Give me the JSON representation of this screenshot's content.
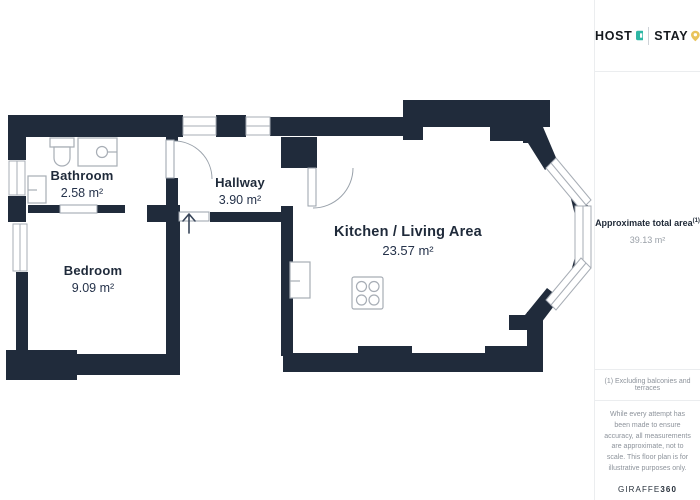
{
  "header": {
    "brand_host": "HOST",
    "brand_stay": "STAY"
  },
  "rooms": [
    {
      "name": "Bathroom",
      "area": "2.58 m²"
    },
    {
      "name": "Hallway",
      "area": "3.90 m²"
    },
    {
      "name": "Bedroom",
      "area": "9.09 m²"
    },
    {
      "name": "Kitchen / Living Area",
      "area": "23.57 m²"
    }
  ],
  "sidebar": {
    "total_area_label": "Approximate total area",
    "total_area_note_ref": "(1)",
    "total_area_value": "39.13 m²",
    "footnote": "(1) Excluding balconies and terraces",
    "disclaimer": "While every attempt has been made to ensure accuracy, all measurements are approximate, not to scale. This floor plan is for illustrative purposes only.",
    "credit_name": "GIRAFFE",
    "credit_number": "360"
  },
  "icons": {
    "host_icon": "door-badge",
    "stay_icon": "location-pin",
    "entrance_arrow": "up-arrow",
    "hob": "four-burner-hob"
  },
  "colors": {
    "wall": "#202b3b",
    "fixture": "#a7adb5",
    "label": "#1f2a3a",
    "host-icon": "#2fb7a5",
    "stay-icon": "#e9c45c",
    "muted": "#8d939b",
    "divider": "#ebedef"
  }
}
